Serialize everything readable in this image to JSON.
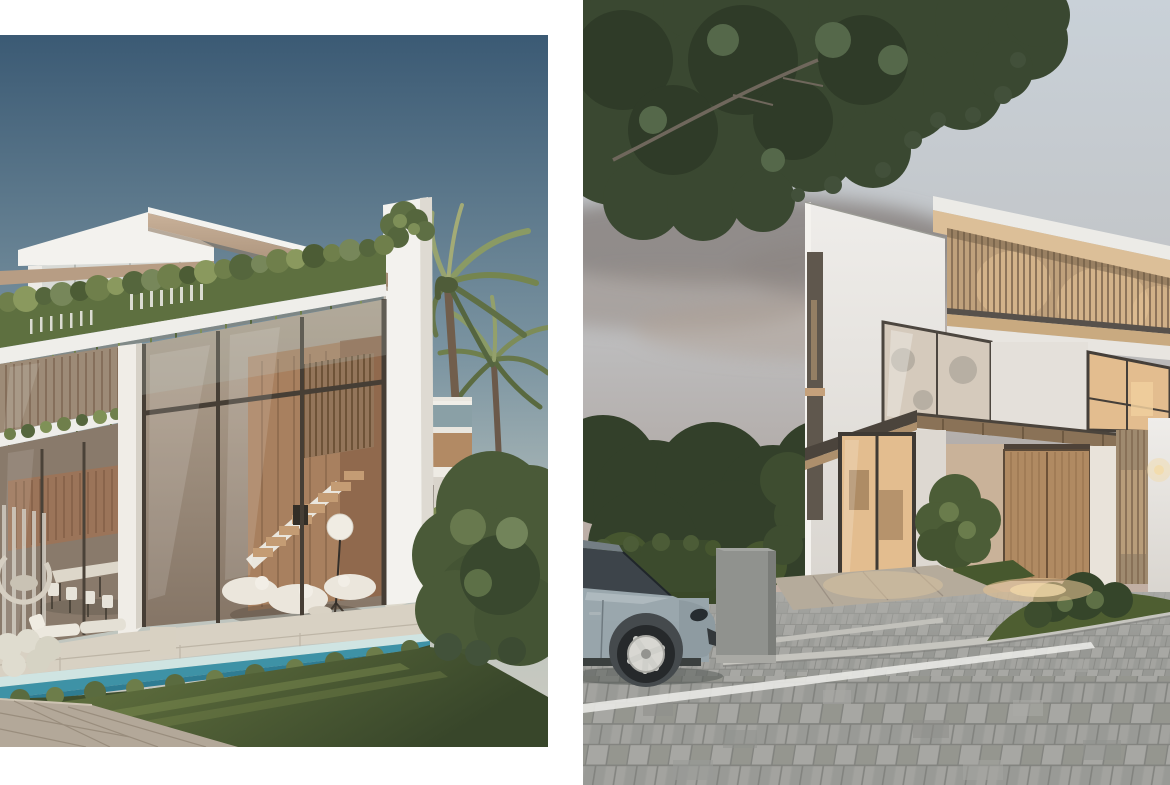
{
  "page": {
    "background": "#ffffff"
  },
  "panels": {
    "left": {
      "label": "Daytime render of a modern glass villa with roof greenery, pool terrace and palm trees",
      "scene": "day",
      "colors": {
        "sky_top": "#3B5A74",
        "sky_horizon": "#CDCCC2",
        "roof_wood": "#BCA184",
        "foliage": "#5E7040",
        "facade_white": "#F3F2EE",
        "glass": "#9A897A",
        "interior_wood": "#A8805F",
        "pool_water": "#3E92A6",
        "grass": "#56682F",
        "stone": "#D8D1C3",
        "path": "#B3A899"
      }
    },
    "right": {
      "label": "Dusk render of a modern villa with wooden slat screen, parked car and paved driveway",
      "scene": "dusk",
      "colors": {
        "sky_top": "#C9D1D8",
        "sky_warm": "#C6B0A2",
        "cloud": "#847D7A",
        "tree": "#3A4831",
        "facade_white": "#E9E6E2",
        "slat_wood": "#BFA17C",
        "window_glow": "#E3BD8F",
        "door_wood": "#B08A62",
        "car_body": "#98A5AB",
        "paving": "#9D9D9A",
        "grass": "#4E5E31",
        "curb": "#C6C5BF",
        "pillar": "#90928E",
        "hedge": "#3C4B2D"
      }
    }
  }
}
